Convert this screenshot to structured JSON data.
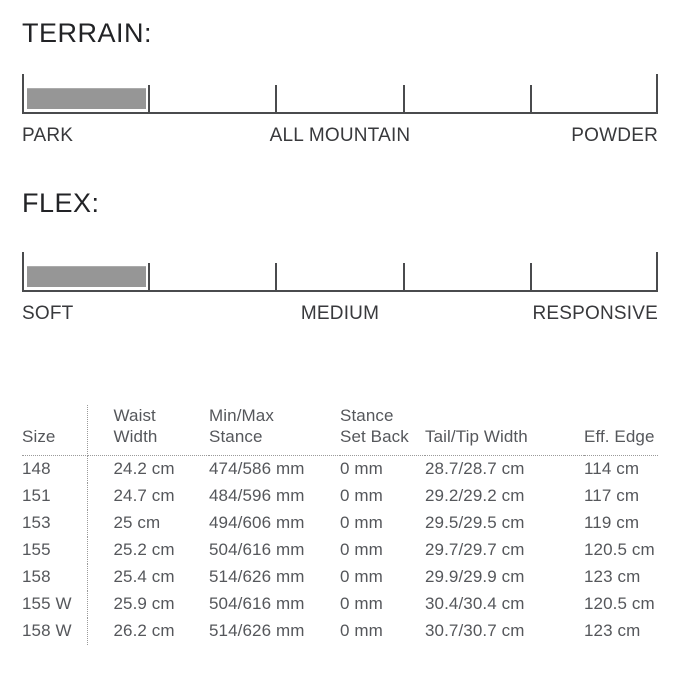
{
  "terrain_section": {
    "heading": "TERRAIN:",
    "scale": {
      "segments": 5,
      "filled_segment_index": 0,
      "labels": [
        {
          "text": "PARK",
          "position": "left"
        },
        {
          "text": "ALL MOUNTAIN",
          "position": "center"
        },
        {
          "text": "POWDER",
          "position": "right"
        }
      ]
    }
  },
  "flex_section": {
    "heading": "FLEX:",
    "scale": {
      "segments": 5,
      "filled_segment_index": 0,
      "labels": [
        {
          "text": "SOFT",
          "position": "left"
        },
        {
          "text": "MEDIUM",
          "position": "center"
        },
        {
          "text": "RESPONSIVE",
          "position": "right"
        }
      ]
    }
  },
  "colors": {
    "background": "#ffffff",
    "scale_line": "#4a4b4d",
    "scale_fill_bar": "#969696",
    "heading_text": "#222326",
    "label_text": "#38393c",
    "table_text": "#55575b",
    "dotted_divider": "#9a9a9a"
  },
  "spec_table": {
    "headers": [
      {
        "line1": "",
        "line2": "Size"
      },
      {
        "line1": "Waist",
        "line2": "Width"
      },
      {
        "line1": "Min/Max",
        "line2": "Stance"
      },
      {
        "line1": "Stance",
        "line2": "Set Back"
      },
      {
        "line1": "",
        "line2": "Tail/Tip Width"
      },
      {
        "line1": "",
        "line2": "Eff. Edge"
      }
    ],
    "rows": [
      {
        "size": "148",
        "waist_width": "24.2 cm",
        "min_max_stance": "474/586 mm",
        "stance_set_back": "0 mm",
        "tail_tip_width": "28.7/28.7 cm",
        "eff_edge": "114 cm"
      },
      {
        "size": "151",
        "waist_width": "24.7 cm",
        "min_max_stance": "484/596 mm",
        "stance_set_back": "0 mm",
        "tail_tip_width": "29.2/29.2 cm",
        "eff_edge": "117 cm"
      },
      {
        "size": "153",
        "waist_width": "25 cm",
        "min_max_stance": "494/606 mm",
        "stance_set_back": "0 mm",
        "tail_tip_width": "29.5/29.5 cm",
        "eff_edge": "119 cm"
      },
      {
        "size": "155",
        "waist_width": "25.2 cm",
        "min_max_stance": "504/616 mm",
        "stance_set_back": "0 mm",
        "tail_tip_width": "29.7/29.7 cm",
        "eff_edge": "120.5 cm"
      },
      {
        "size": "158",
        "waist_width": "25.4 cm",
        "min_max_stance": "514/626 mm",
        "stance_set_back": "0 mm",
        "tail_tip_width": "29.9/29.9 cm",
        "eff_edge": "123 cm"
      },
      {
        "size": "155 W",
        "waist_width": "25.9 cm",
        "min_max_stance": "504/616 mm",
        "stance_set_back": "0 mm",
        "tail_tip_width": "30.4/30.4 cm",
        "eff_edge": "120.5 cm"
      },
      {
        "size": "158 W",
        "waist_width": "26.2 cm",
        "min_max_stance": "514/626 mm",
        "stance_set_back": "0 mm",
        "tail_tip_width": "30.7/30.7 cm",
        "eff_edge": "123 cm"
      }
    ]
  }
}
